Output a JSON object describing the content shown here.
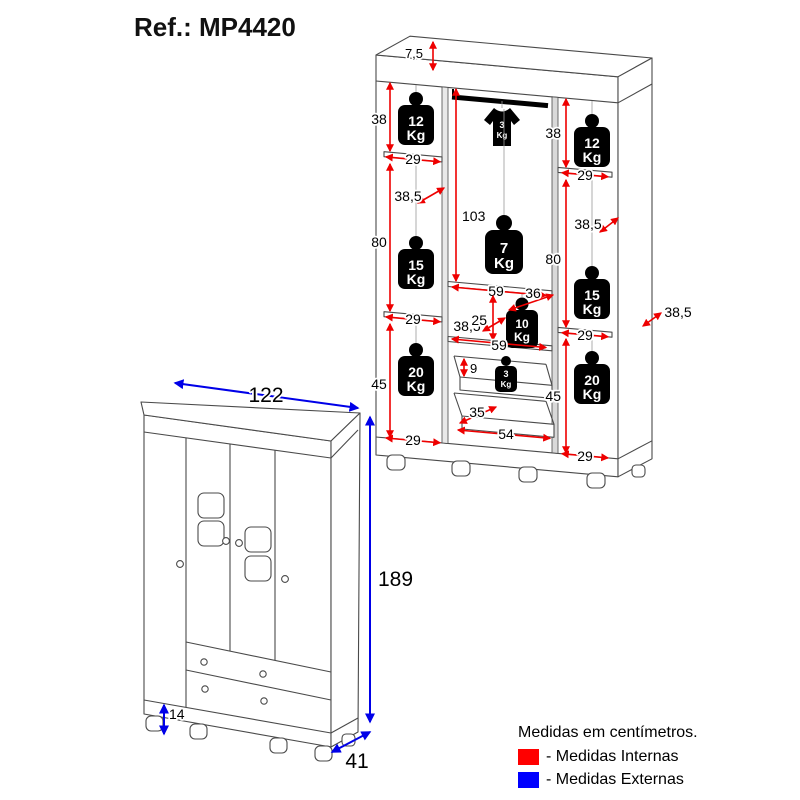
{
  "title": "Ref.: MP4420",
  "unit": "Kg",
  "colors": {
    "red_internal": "#ff0000",
    "blue_external": "#0000ff",
    "line": "#4a4a4a",
    "icon": "#000000"
  },
  "internal": {
    "top_panel_height": "7,5",
    "left_column": {
      "top_height": "38",
      "top_width": "29",
      "top_capacity": "12",
      "mid_depth": "38,5",
      "mid_height": "80",
      "mid_width": "29",
      "mid_capacity": "15",
      "bottom_height": "45",
      "bottom_width": "29",
      "bottom_capacity": "20"
    },
    "center_column": {
      "hanging_height": "103",
      "rod_capacity": "3",
      "shelf_width": "59",
      "shelf_depth": "36",
      "shelf_capacity": "7",
      "niche_depth": "38,5",
      "niche_height": "25",
      "niche_width": "59",
      "niche_capacity": "10",
      "drawer_inner_height": "9",
      "drawer_capacity": "3",
      "drawer_depth": "35",
      "drawer_width": "54"
    },
    "right_column": {
      "top_height": "38",
      "top_width": "29",
      "top_capacity": "12",
      "mid_depth": "38,5",
      "mid_height": "80",
      "mid_width": "29",
      "mid_capacity": "15",
      "side_depth": "38,5",
      "bottom_height": "45",
      "bottom_width": "29",
      "bottom_capacity": "20"
    }
  },
  "external": {
    "width": "122",
    "height": "189",
    "depth": "41",
    "foot_height": "14"
  },
  "legend": {
    "title": "Medidas em centímetros.",
    "internal_label": "- Medidas Internas",
    "external_label": "- Medidas Externas"
  }
}
